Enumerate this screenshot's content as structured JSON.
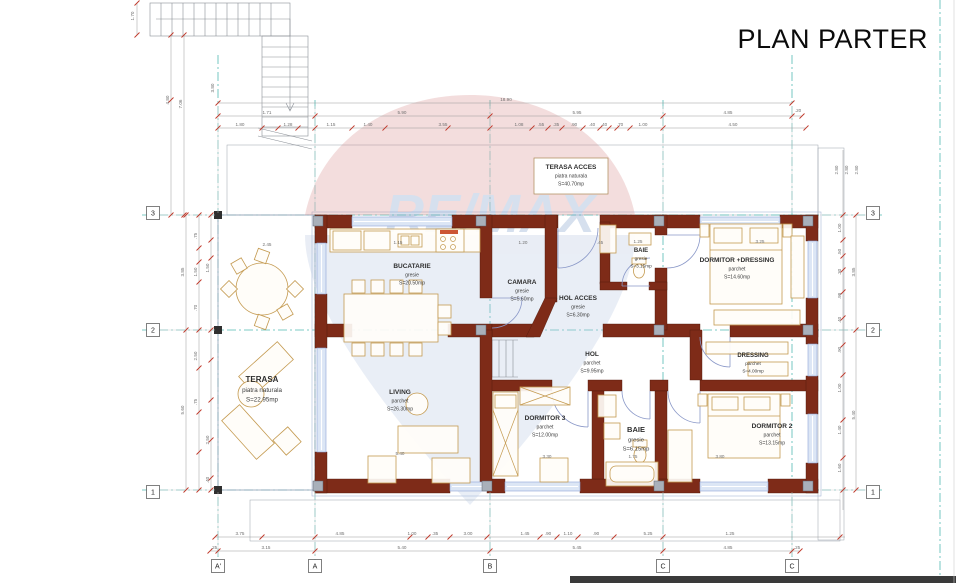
{
  "title": "PLAN PARTER",
  "watermark": {
    "text": "RE/MAX",
    "red": "#d89090",
    "blue": "#b7c7e0",
    "letters": "#7b9cc9"
  },
  "colors": {
    "wall": "#7e2b18",
    "grid_line": "#54bab4",
    "dim_tick": "#c0392b",
    "furniture": "#c49a50",
    "window": "#8fa6d8",
    "footer_bar": "#3a3a3a"
  },
  "grid": {
    "bubbles": [
      {
        "t": "3",
        "x": 153,
        "y": 213
      },
      {
        "t": "2",
        "x": 153,
        "y": 330
      },
      {
        "t": "1",
        "x": 153,
        "y": 492
      },
      {
        "t": "3",
        "x": 873,
        "y": 213
      },
      {
        "t": "2",
        "x": 873,
        "y": 330
      },
      {
        "t": "1",
        "x": 873,
        "y": 492
      },
      {
        "t": "A'",
        "x": 218,
        "y": 566
      },
      {
        "t": "A",
        "x": 315,
        "y": 566
      },
      {
        "t": "B",
        "x": 490,
        "y": 566
      },
      {
        "t": "C",
        "x": 663,
        "y": 566
      },
      {
        "t": "C",
        "x": 792,
        "y": 566
      }
    ]
  },
  "rooms": [
    {
      "name": "TERASA ACCES",
      "finish": "piatra naturala",
      "area": "S=40.70mp",
      "x": 571,
      "y": 169,
      "fs": 6.5
    },
    {
      "name": "BUCATARIE",
      "finish": "gresie",
      "area": "S=20.50mp",
      "x": 412,
      "y": 268,
      "fs": 6.5
    },
    {
      "name": "CAMARA",
      "finish": "gresie",
      "area": "S=5.60mp",
      "x": 522,
      "y": 284,
      "fs": 6.5
    },
    {
      "name": "HOL ACCES",
      "finish": "gresie",
      "area": "S=6.30mp",
      "x": 578,
      "y": 300,
      "fs": 6.5
    },
    {
      "name": "BAIE",
      "finish": "gresie",
      "area": "S=3.15mp",
      "x": 641,
      "y": 252,
      "fs": 6
    },
    {
      "name": "DORMITOR +DRESSING",
      "finish": "parchet",
      "area": "S=14.60mp",
      "x": 737,
      "y": 262,
      "fs": 6.5
    },
    {
      "name": "HOL",
      "finish": "parchet",
      "area": "S=9.95mp",
      "x": 592,
      "y": 356,
      "fs": 6.5
    },
    {
      "name": "DRESSING",
      "finish": "parchet",
      "area": "S=4.00mp",
      "x": 753,
      "y": 357,
      "fs": 6
    },
    {
      "name": "LIVING",
      "finish": "parchet",
      "area": "S=26.30mp",
      "x": 400,
      "y": 394,
      "fs": 6.5
    },
    {
      "name": "TERASA",
      "finish": "piatra naturala",
      "area": "S=22.95mp",
      "x": 262,
      "y": 382,
      "fs": 8
    },
    {
      "name": "DORMITOR 3",
      "finish": "parchet",
      "area": "S=12.00mp",
      "x": 545,
      "y": 420,
      "fs": 6.5
    },
    {
      "name": "BAIE",
      "finish": "gresie",
      "area": "S=6.15mp",
      "x": 636,
      "y": 432,
      "fs": 7.5
    },
    {
      "name": "DORMITOR 2",
      "finish": "parchet",
      "area": "S=13.15mp",
      "x": 772,
      "y": 428,
      "fs": 6.5
    }
  ],
  "dim_labels": [
    {
      "t": "18.90",
      "x": 506,
      "y": 101
    },
    {
      "t": "1.71",
      "x": 267,
      "y": 114
    },
    {
      "t": "5.90",
      "x": 402,
      "y": 114
    },
    {
      "t": "5.95",
      "x": 577,
      "y": 114
    },
    {
      "t": "4.85",
      "x": 728,
      "y": 114
    },
    {
      "t": ".20",
      "x": 798,
      "y": 112
    },
    {
      "t": "1.80",
      "x": 240,
      "y": 126
    },
    {
      "t": "1.28",
      "x": 288,
      "y": 126
    },
    {
      "t": "1.15",
      "x": 331,
      "y": 126
    },
    {
      "t": "1.40",
      "x": 368,
      "y": 126
    },
    {
      "t": "3.55",
      "x": 443,
      "y": 126
    },
    {
      "t": "1.08",
      "x": 519,
      "y": 126
    },
    {
      "t": ".55",
      "x": 541,
      "y": 126
    },
    {
      "t": ".35",
      "x": 556,
      "y": 126
    },
    {
      "t": ".90",
      "x": 574,
      "y": 126
    },
    {
      "t": ".40",
      "x": 592,
      "y": 126
    },
    {
      "t": ".40",
      "x": 604,
      "y": 126
    },
    {
      "t": ".70",
      "x": 620,
      "y": 126
    },
    {
      "t": "1.00",
      "x": 643,
      "y": 126
    },
    {
      "t": "4.50",
      "x": 733,
      "y": 126
    },
    {
      "t": "3.75",
      "x": 240,
      "y": 535
    },
    {
      "t": "4.85",
      "x": 340,
      "y": 535
    },
    {
      "t": "1.00",
      "x": 412,
      "y": 535
    },
    {
      "t": ".35",
      "x": 435,
      "y": 535
    },
    {
      "t": "3.00",
      "x": 468,
      "y": 535
    },
    {
      "t": "1.45",
      "x": 525,
      "y": 535
    },
    {
      "t": ".90",
      "x": 548,
      "y": 535
    },
    {
      "t": "1.10",
      "x": 568,
      "y": 535
    },
    {
      "t": ".90",
      "x": 596,
      "y": 535
    },
    {
      "t": "5.25",
      "x": 648,
      "y": 535
    },
    {
      "t": "1.25",
      "x": 730,
      "y": 535
    },
    {
      "t": ".25",
      "x": 214,
      "y": 549
    },
    {
      "t": "3.15",
      "x": 266,
      "y": 549
    },
    {
      "t": "5.40",
      "x": 402,
      "y": 549
    },
    {
      "t": "5.45",
      "x": 577,
      "y": 549
    },
    {
      "t": "4.85",
      "x": 728,
      "y": 549
    },
    {
      "t": ".25",
      "x": 797,
      "y": 549
    },
    {
      "t": "1.70",
      "x": 134,
      "y": 16,
      "r": 1
    },
    {
      "t": "4.80",
      "x": 169,
      "y": 100,
      "r": 1
    },
    {
      "t": "7.06",
      "x": 182,
      "y": 104,
      "r": 1
    },
    {
      "t": "3.80",
      "x": 214,
      "y": 88,
      "r": 1
    },
    {
      "t": "3.85",
      "x": 184,
      "y": 272,
      "r": 1
    },
    {
      "t": "5.60",
      "x": 184,
      "y": 410,
      "r": 1
    },
    {
      "t": ".75",
      "x": 197,
      "y": 236,
      "r": 1
    },
    {
      "t": "1.50",
      "x": 197,
      "y": 272,
      "r": 1
    },
    {
      "t": ".70",
      "x": 197,
      "y": 308,
      "r": 1
    },
    {
      "t": "2.50",
      "x": 197,
      "y": 356,
      "r": 1
    },
    {
      "t": ".75",
      "x": 197,
      "y": 402,
      "r": 1
    },
    {
      "t": "1.50",
      "x": 209,
      "y": 268,
      "r": 1
    },
    {
      "t": "2.50",
      "x": 209,
      "y": 440,
      "r": 1
    },
    {
      "t": ".40",
      "x": 209,
      "y": 480,
      "r": 1
    },
    {
      "t": "2.80",
      "x": 838,
      "y": 170,
      "r": 1
    },
    {
      "t": "2.80",
      "x": 848,
      "y": 170,
      "r": 1
    },
    {
      "t": "2.80",
      "x": 858,
      "y": 170,
      "r": 1
    },
    {
      "t": "1.00",
      "x": 841,
      "y": 228,
      "r": 1
    },
    {
      "t": ".50",
      "x": 841,
      "y": 252,
      "r": 1
    },
    {
      "t": ".30",
      "x": 841,
      "y": 272,
      "r": 1
    },
    {
      "t": ".98",
      "x": 841,
      "y": 296,
      "r": 1
    },
    {
      "t": ".40",
      "x": 841,
      "y": 320,
      "r": 1
    },
    {
      "t": ".90",
      "x": 841,
      "y": 350,
      "r": 1
    },
    {
      "t": "1.00",
      "x": 841,
      "y": 388,
      "r": 1
    },
    {
      "t": "1.40",
      "x": 841,
      "y": 430,
      "r": 1
    },
    {
      "t": "1.60",
      "x": 841,
      "y": 468,
      "r": 1
    },
    {
      "t": "3.85",
      "x": 855,
      "y": 272,
      "r": 1
    },
    {
      "t": "5.40",
      "x": 855,
      "y": 415,
      "r": 1
    },
    {
      "t": "1.15",
      "x": 398,
      "y": 244
    },
    {
      "t": "1.20",
      "x": 523,
      "y": 244
    },
    {
      "t": ".45",
      "x": 600,
      "y": 244
    },
    {
      "t": "1.25",
      "x": 638,
      "y": 243
    },
    {
      "t": "3.25",
      "x": 760,
      "y": 243
    },
    {
      "t": "2.45",
      "x": 267,
      "y": 246
    },
    {
      "t": "5.40",
      "x": 400,
      "y": 455
    },
    {
      "t": "3.30",
      "x": 547,
      "y": 458
    },
    {
      "t": "1.75",
      "x": 633,
      "y": 458
    },
    {
      "t": "3.80",
      "x": 720,
      "y": 458
    }
  ]
}
